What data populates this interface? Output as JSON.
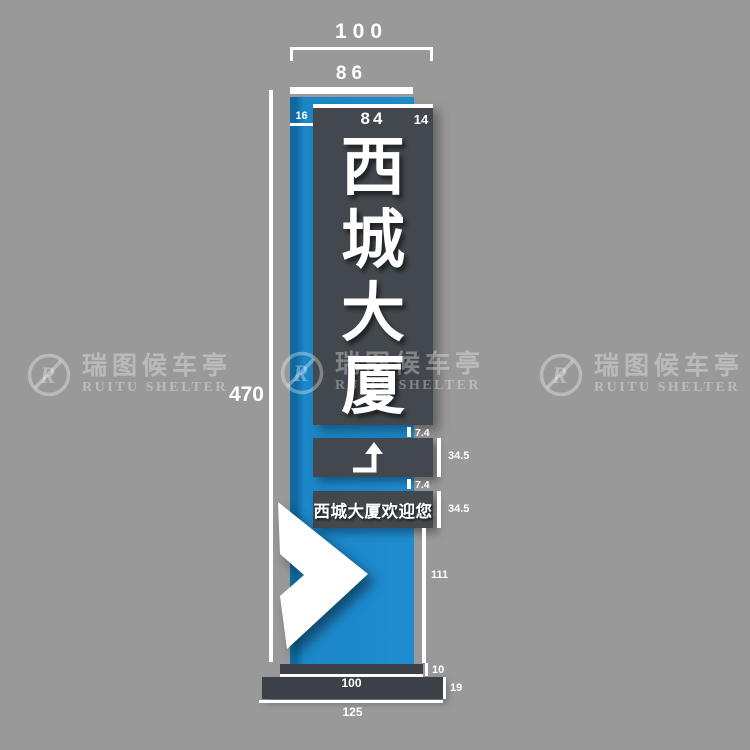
{
  "colors": {
    "background": "#9a9999",
    "pillar_blue": "#1b86c8",
    "panel_dark": "#43484e",
    "base_dark": "#3b4147",
    "annotation_white": "#ffffff"
  },
  "sign": {
    "title_chars": [
      "西",
      "城",
      "大",
      "厦"
    ],
    "welcome_text": "西城大厦欢迎您"
  },
  "dimensions": {
    "outer_width": "100",
    "pillar_width": "86",
    "panel_width": "84",
    "left_inset": "16",
    "right_overhang": "14",
    "total_height": "470",
    "gap_top": "7.4",
    "arrow_plaque_height": "34.5",
    "gap_bottom": "7.4",
    "welcome_plaque_height": "34.5",
    "lower_section_height": "111",
    "cap_height": "10",
    "cap_width": "100",
    "base_height": "19",
    "base_width": "125"
  },
  "watermark": {
    "logo_letter": "R",
    "cn": "瑞图候车亭",
    "en": "RUITU SHELTER"
  }
}
